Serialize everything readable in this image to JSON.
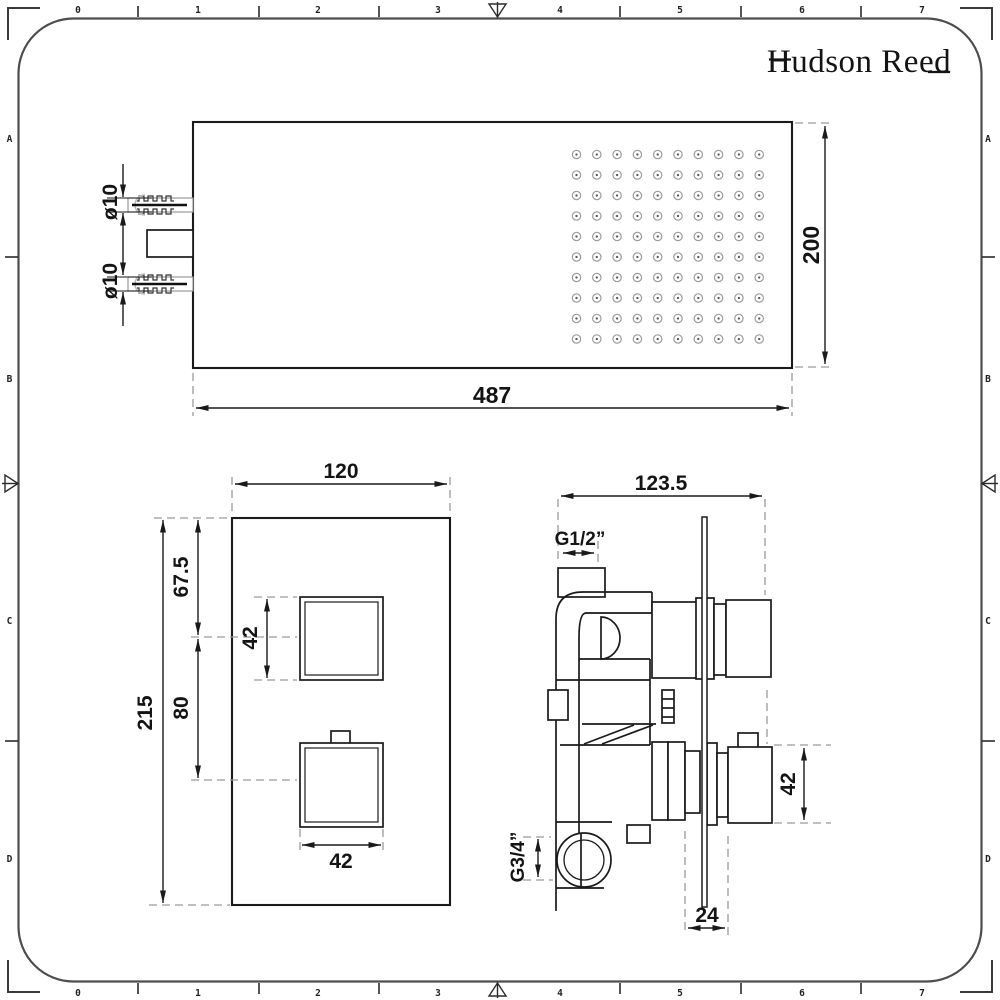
{
  "brand": {
    "logo_text": "Hudson Reed"
  },
  "colors": {
    "background": "#ffffff",
    "line": "#1a1a1a",
    "frame": "#4d4d4d",
    "dashed": "#9a9a9a"
  },
  "frame": {
    "ruler_numbers": [
      "0",
      "1",
      "2",
      "3",
      "4",
      "5",
      "6",
      "7"
    ],
    "row_letters": [
      "A",
      "B",
      "C",
      "D"
    ]
  },
  "shower_head": {
    "width_label": "487",
    "depth_label": "200",
    "inlet_top_label": "ø10",
    "inlet_bottom_label": "ø10",
    "nozzle_grid": {
      "rows": 10,
      "cols": 10
    }
  },
  "valve_front": {
    "width_label": "120",
    "height_label": "215",
    "top_offset_label": "67.5",
    "handle_height_label": "42",
    "handle_spacing_label": "80",
    "handle_width_label": "42"
  },
  "valve_side": {
    "depth_label": "123.5",
    "inlet_thread_label": "G1/2”",
    "outlet_thread_label": "G3/4”",
    "handle_height_label": "42",
    "plate_depth_label": "24"
  }
}
